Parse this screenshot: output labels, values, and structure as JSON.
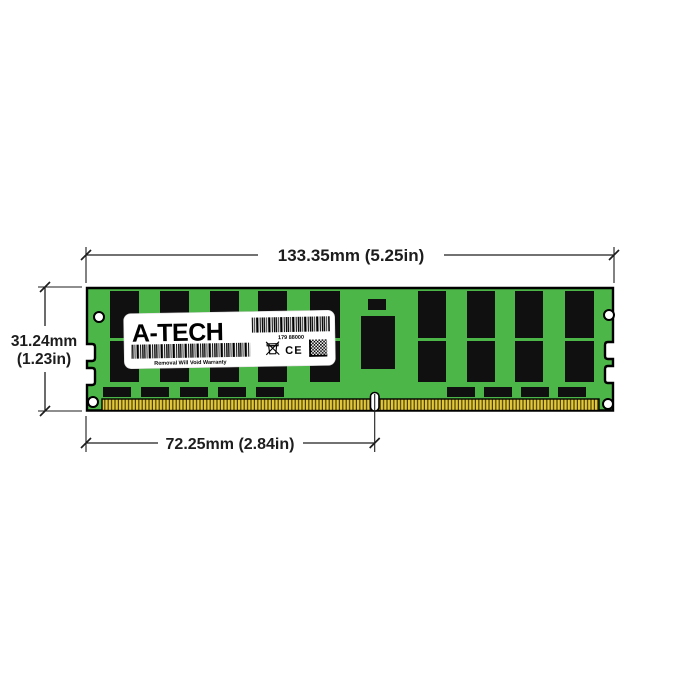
{
  "dimensions": {
    "width": "133.35mm (5.25in)",
    "height_mm": "31.24mm",
    "height_in": "(1.23in)",
    "notch_offset": "72.25mm (2.84in)"
  },
  "label": {
    "brand": "A-TECH",
    "barcode_number": "179 88000",
    "warranty": "Removal Will Void Warranty",
    "ce": "CE"
  },
  "colors": {
    "background": "#ffffff",
    "pcb-green": "#4cb648",
    "chip-black": "#101010",
    "pin-gold": "#e3c83e",
    "pin-stripe": "#4a4000",
    "label-white": "#ffffff",
    "line-color": "#1d1d1d"
  }
}
